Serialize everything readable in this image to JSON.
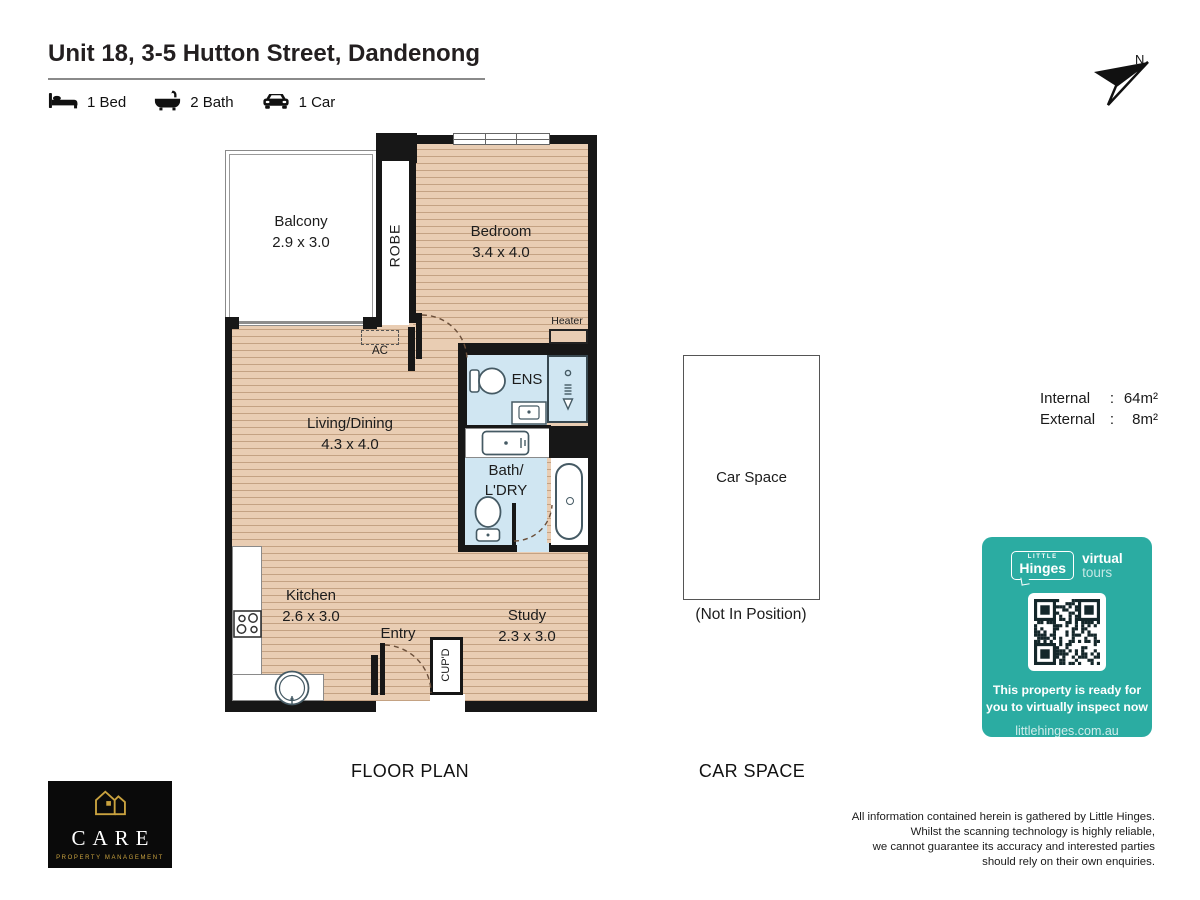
{
  "header": {
    "title": "Unit 18, 3-5 Hutton Street, Dandenong",
    "features": [
      {
        "icon": "bed-icon",
        "label": "1 Bed"
      },
      {
        "icon": "bath-icon",
        "label": "2 Bath"
      },
      {
        "icon": "car-icon",
        "label": "1 Car"
      }
    ],
    "north_label": "N"
  },
  "floorplan": {
    "caption": "FLOOR PLAN",
    "rooms": {
      "balcony": {
        "name": "Balcony",
        "dims": "2.9 x 3.0"
      },
      "bedroom": {
        "name": "Bedroom",
        "dims": "3.4 x 4.0"
      },
      "living": {
        "name": "Living/Dining",
        "dims": "4.3 x 4.0"
      },
      "kitchen": {
        "name": "Kitchen",
        "dims": "2.6 x 3.0"
      },
      "study": {
        "name": "Study",
        "dims": "2.3 x 3.0"
      },
      "bath": {
        "line1": "Bath/",
        "line2": "L'DRY"
      },
      "ens": {
        "name": "ENS"
      },
      "robe": {
        "name": "ROBE"
      },
      "cupboard": {
        "name": "CUP'D"
      },
      "entry": {
        "name": "Entry"
      },
      "ac": {
        "name": "AC"
      },
      "heater": {
        "name": "Heater"
      }
    }
  },
  "carspace": {
    "caption": "CAR SPACE",
    "label": "Car Space",
    "note": "(Not In Position)"
  },
  "areas": {
    "rows": [
      {
        "label": "Internal",
        "sep": ":",
        "value": "64m²"
      },
      {
        "label": "External",
        "sep": ":",
        "value": "8m²"
      }
    ]
  },
  "badge": {
    "accent": "#2BACA2",
    "brand_top": "LITTLE",
    "brand": "Hinges",
    "product_word1": "virtual",
    "product_word2": "tours",
    "message_line1": "This property is ready for",
    "message_line2": "you to virtually inspect now",
    "url": "littlehinges.com.au"
  },
  "agency": {
    "name": "CARE",
    "tagline": "PROPERTY MANAGEMENT",
    "brand_black": "#0a0a0a",
    "brand_gold": "#C9A23F"
  },
  "disclaimer": {
    "lines": [
      "All information contained herein is gathered by Little Hinges.",
      "Whilst the scanning technology is highly reliable,",
      "we cannot guarantee its accuracy and interested parties",
      "should rely on their own enquiries."
    ]
  }
}
